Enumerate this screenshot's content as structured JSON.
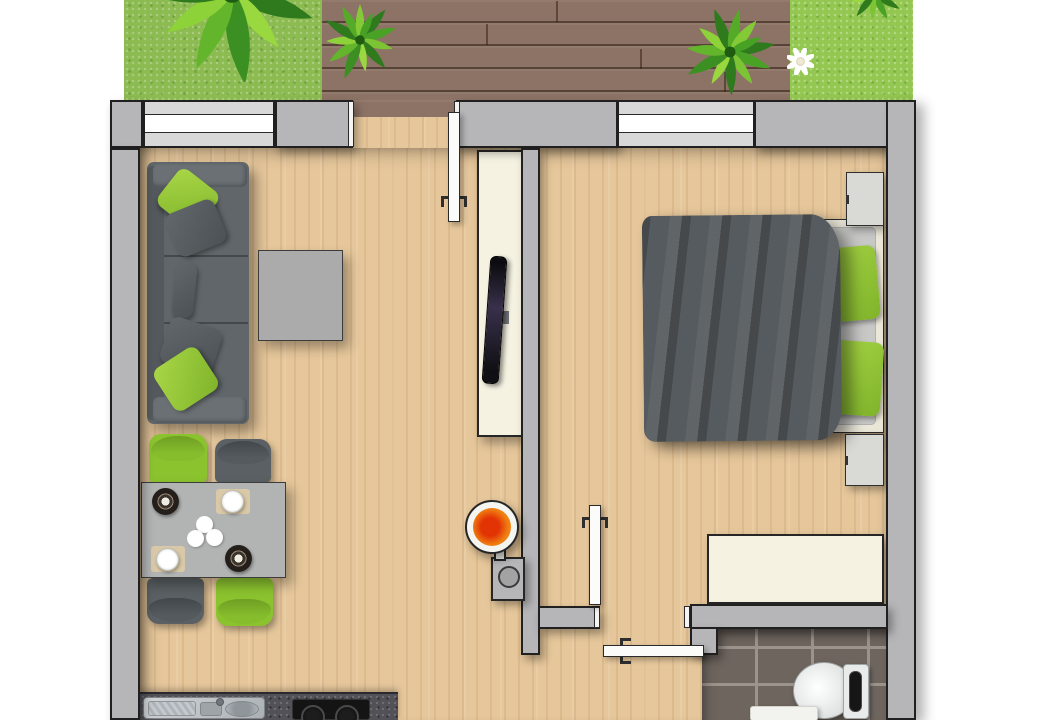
{
  "scene": {
    "type": "apartment-floor-plan",
    "view": "top-down-3d-render",
    "text_labels": [],
    "rooms": [
      {
        "name": "terrace-garden",
        "position": "top",
        "features": [
          "lawn-left",
          "wood-plank-deck",
          "lawn-right",
          "large-bush",
          "deck-plant-left",
          "deck-plant-right",
          "small-bush",
          "daisy-flower"
        ]
      },
      {
        "name": "living-dining-room",
        "position": "left",
        "furniture": [
          "three-seat-sofa",
          "green-pillow-top",
          "gray-pillow-top",
          "lumbar-pillow",
          "gray-pillow-bottom",
          "green-pillow-bottom",
          "square-coffee-table",
          "dining-table",
          "place-setting-dark-1",
          "place-setting-white-1",
          "place-setting-white-2",
          "place-setting-dark-2",
          "flower-centerpiece",
          "chair-green-top-left",
          "chair-gray-top-right",
          "chair-gray-bottom-left",
          "chair-green-bottom-right"
        ]
      },
      {
        "name": "hallway",
        "position": "center",
        "furniture": [
          "tv-sideboard",
          "flatscreen-tv",
          "wood-stove-with-fire"
        ]
      },
      {
        "name": "kitchen",
        "position": "bottom-left",
        "furniture": [
          "stone-countertop",
          "stainless-double-sink",
          "black-cooktop-two-burners"
        ]
      },
      {
        "name": "bedroom",
        "position": "right",
        "furniture": [
          "double-bed",
          "dark-gray-duvet",
          "green-pillow-1",
          "green-pillow-2",
          "nightstand-top",
          "nightstand-bottom",
          "cream-dresser"
        ]
      },
      {
        "name": "bathroom",
        "position": "bottom-right",
        "furniture": [
          "dark-floor-tiles",
          "wall-hung-toilet",
          "bath-mat"
        ]
      }
    ],
    "openings": {
      "windows": [
        "living-room-window-top",
        "bedroom-window-top"
      ],
      "doors": [
        "terrace-door-open",
        "bedroom-door-open",
        "bathroom-door-open"
      ]
    },
    "counts": {
      "chairs": 4,
      "place_settings": 4,
      "pillows_sofa": 5,
      "pillows_bed": 2,
      "plants": 4,
      "flowers": 1,
      "windows": 2,
      "door_leaves": 3
    }
  },
  "palette": {
    "page_bg": "#ffffff",
    "grass": "#8cbb51",
    "deck": "#8c7365",
    "floor": "#e6c79b",
    "wall": "#b6b6b8",
    "wall_outline": "#202020",
    "tile": "#6e655e",
    "sofa": "#60666a",
    "accent_green": "#8bc32f",
    "coffee_table": "#ababab",
    "cream": "#f5f2e2",
    "duvet": "#565b5f",
    "mattress": "#c8c8c7",
    "bed_frame": "#eae6d8",
    "counter": "#515157",
    "fire_orange": "#ef7b10",
    "fire_red": "#e23305"
  }
}
